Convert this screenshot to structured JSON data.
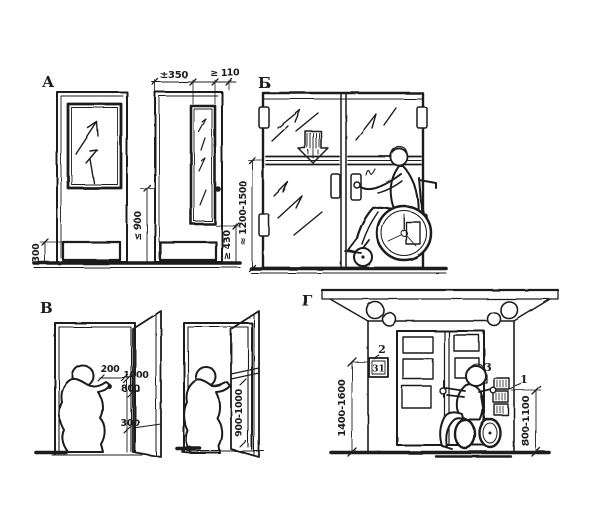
{
  "figure_type": "accessibility-door-requirements-drawing",
  "colors": {
    "ink": "#1c1c1c",
    "paper": "#ffffff"
  },
  "labels": {
    "section_a": "А",
    "section_b": "Б",
    "section_v": "В",
    "section_g": "Г"
  },
  "dims": {
    "a_glazing_width": "±350",
    "a_edge_gap": "≥ 110",
    "a_kick_height": "300",
    "a_handle_height": "≤ 900",
    "a_glazing_bottom": "≥ 430",
    "b_marking_band_height": "≈ 1200-1500",
    "v_handle_offset": "200",
    "v_upper_height": "1000",
    "v_lower_height": "800",
    "v_kick_height": "300",
    "v_rail_height": "900-1000",
    "g_sign_height": "1400-1600",
    "g_panel_height": "800-1100"
  },
  "callouts": {
    "sign_number": "2",
    "sign_text": "31",
    "bell_number": "3",
    "intercom_number": "1"
  }
}
